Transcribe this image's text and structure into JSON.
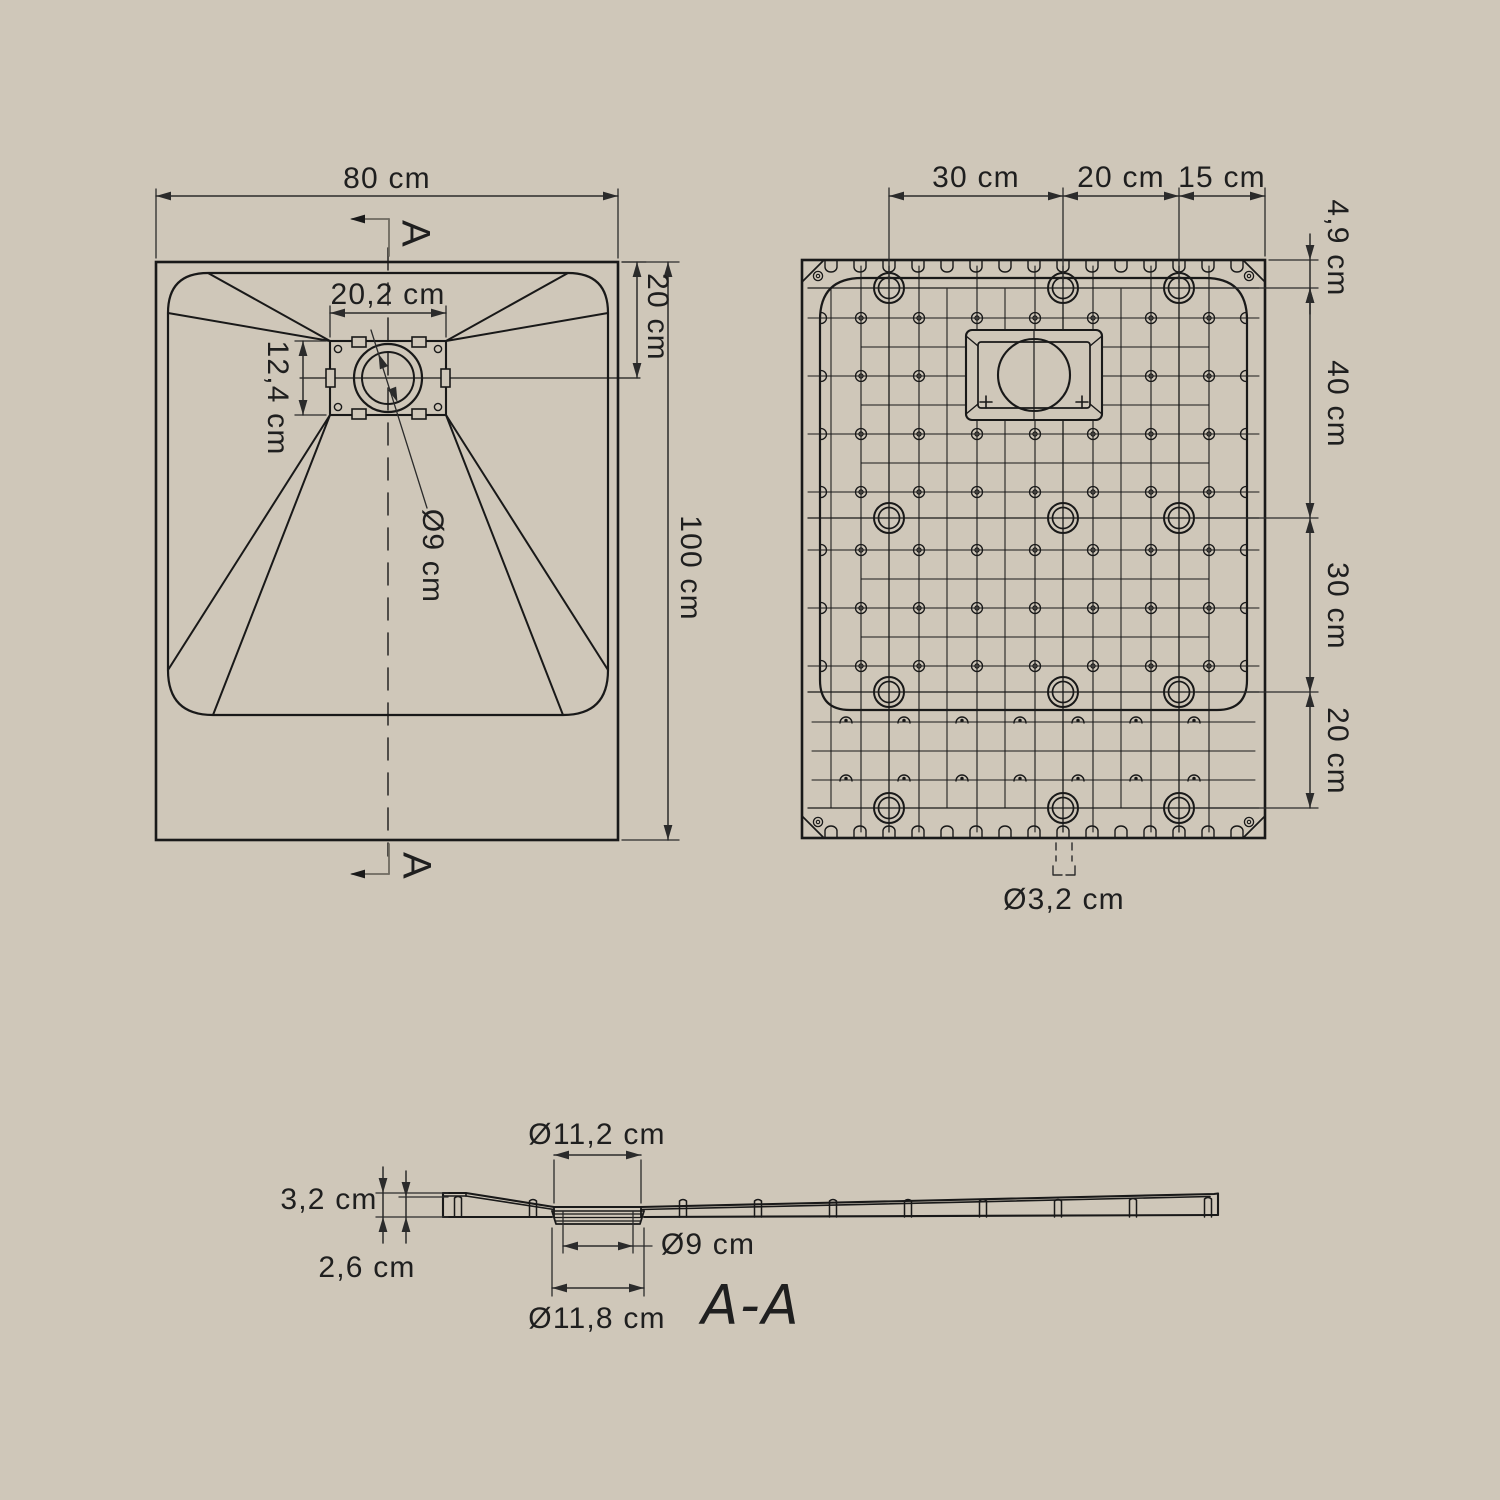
{
  "title": "Shower tray technical drawing",
  "colors": {
    "background": "#cfc7b9",
    "line": "#191919",
    "dimension": "#2b2b2b",
    "marker_line": "#6e6a60"
  },
  "top_view": {
    "width_label": "80 cm",
    "height_label": "100 cm",
    "drain_width_label": "20,2 cm",
    "drain_height_label": "12,4 cm",
    "drain_offset_label": "20 cm",
    "drain_diameter_label": "Ø9 cm",
    "section_letter_top": "A",
    "section_letter_bottom": "A"
  },
  "bottom_view": {
    "top_dims": {
      "left": "30 cm",
      "middle": "20 cm",
      "right": "15 cm"
    },
    "side_dims": {
      "edge": "4,9 cm",
      "upper": "40 cm",
      "middle": "30 cm",
      "lower": "20 cm"
    },
    "foot_hole_diameter_label": "Ø3,2 cm"
  },
  "section_view": {
    "recess_diameter_label": "Ø11,2 cm",
    "edge_height_label": "3,2 cm",
    "base_height_label": "2,6 cm",
    "drain_diameter_label": "Ø9 cm",
    "flange_diameter_label": "Ø11,8 cm",
    "title": "A-A"
  }
}
